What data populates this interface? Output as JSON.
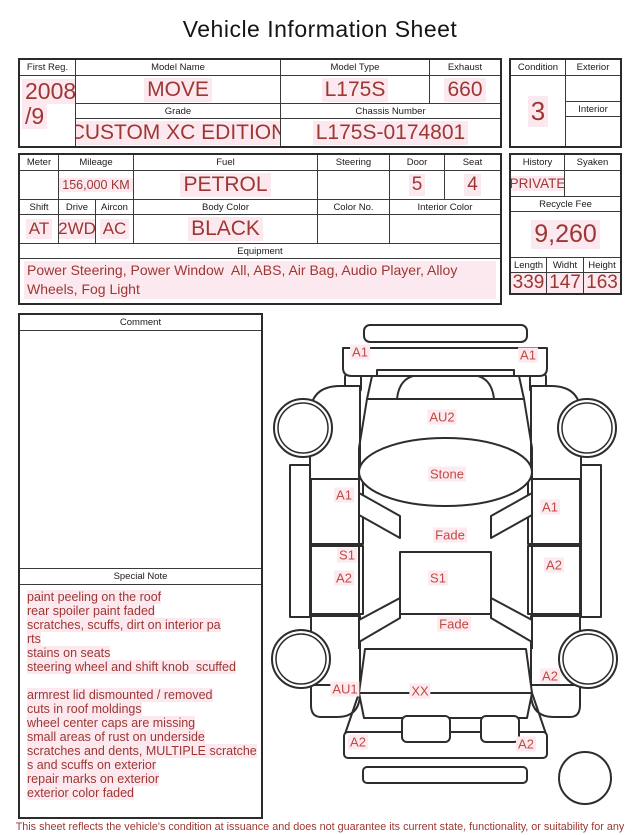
{
  "title": "Vehicle Information Sheet",
  "table1": {
    "first_reg_label": "First Reg.",
    "first_reg_line1": "2008",
    "first_reg_line2": "/9",
    "model_name_label": "Model Name",
    "model_name_value": "MOVE",
    "model_type_label": "Model Type",
    "model_type_value": "L175S",
    "exhaust_label": "Exhaust",
    "exhaust_value": "660",
    "grade_label": "Grade",
    "grade_value": "CUSTOM XC EDITION",
    "chassis_label": "Chassis Number",
    "chassis_value": "L175S-0174801"
  },
  "condition_box": {
    "condition_label": "Condition",
    "condition_value": "3",
    "exterior_label": "Exterior",
    "exterior_value": "",
    "interior_label": "Interior",
    "interior_value": ""
  },
  "table2": {
    "meter_label": "Meter",
    "meter_value": "",
    "mileage_label": "Mileage",
    "mileage_value": "156,000 KM",
    "fuel_label": "Fuel",
    "fuel_value": "PETROL",
    "steering_label": "Steering",
    "steering_value": "",
    "door_label": "Door",
    "door_value": "5",
    "seat_label": "Seat",
    "seat_value": "4",
    "shift_label": "Shift",
    "shift_value": "AT",
    "drive_label": "Drive",
    "drive_value": "2WD",
    "aircon_label": "Aircon",
    "aircon_value": "AC",
    "body_color_label": "Body Color",
    "body_color_value": "BLACK",
    "color_no_label": "Color No.",
    "color_no_value": "",
    "interior_color_label": "Interior Color",
    "interior_color_value": "",
    "equipment_label": "Equipment",
    "equipment_value": "Power Steering, Power Window  All, ABS, Air Bag, Audio Player, Alloy Wheels, Fog Light"
  },
  "history_box": {
    "history_label": "History",
    "history_value": "PRIVATE",
    "syaken_label": "Syaken",
    "syaken_value": "",
    "recycle_fee_label": "Recycle Fee",
    "recycle_fee_value": "9,260",
    "length_label": "Length",
    "length_value": "339",
    "width_label": "Widht",
    "width_value": "147",
    "height_label": "Height",
    "height_value": "163"
  },
  "comment": {
    "label": "Comment",
    "value": ""
  },
  "special_note": {
    "label": "Special Note",
    "lines": [
      "paint peeling on the roof",
      "rear spoiler paint faded",
      "scratches, scuffs, dirt on interior pa",
      "rts",
      "stains on seats",
      "steering wheel and shift knob  scuffed",
      "",
      "armrest lid dismounted / removed",
      "cuts in roof moldings",
      "wheel center caps are missing",
      "small areas of rust on underside",
      "scratches and dents, MULTIPLE scratche",
      "s and scuffs on exterior",
      "repair marks on exterior",
      "exterior color faded"
    ]
  },
  "diagram": {
    "labels": [
      {
        "text": "A1",
        "x": 95,
        "y": 44
      },
      {
        "text": "A1",
        "x": 263,
        "y": 47
      },
      {
        "text": "AU2",
        "x": 177,
        "y": 109
      },
      {
        "text": "Stone",
        "x": 182,
        "y": 166
      },
      {
        "text": "A1",
        "x": 79,
        "y": 187
      },
      {
        "text": "A1",
        "x": 285,
        "y": 199
      },
      {
        "text": "Fade",
        "x": 185,
        "y": 227
      },
      {
        "text": "S1",
        "x": 82,
        "y": 247
      },
      {
        "text": "A2",
        "x": 289,
        "y": 257
      },
      {
        "text": "A2",
        "x": 79,
        "y": 270
      },
      {
        "text": "S1",
        "x": 173,
        "y": 270
      },
      {
        "text": "Fade",
        "x": 189,
        "y": 316
      },
      {
        "text": "AU1",
        "x": 80,
        "y": 381
      },
      {
        "text": "XX",
        "x": 155,
        "y": 383
      },
      {
        "text": "A2",
        "x": 285,
        "y": 368
      },
      {
        "text": "A2",
        "x": 93,
        "y": 434
      },
      {
        "text": "A2",
        "x": 261,
        "y": 436
      }
    ]
  },
  "disclaimer": "This sheet reflects the vehicle's condition at issuance and does not guarantee its current state, functionality, or suitability for any purpose",
  "colors": {
    "accent": "#9d3733",
    "highlight": "#fce8ef"
  }
}
